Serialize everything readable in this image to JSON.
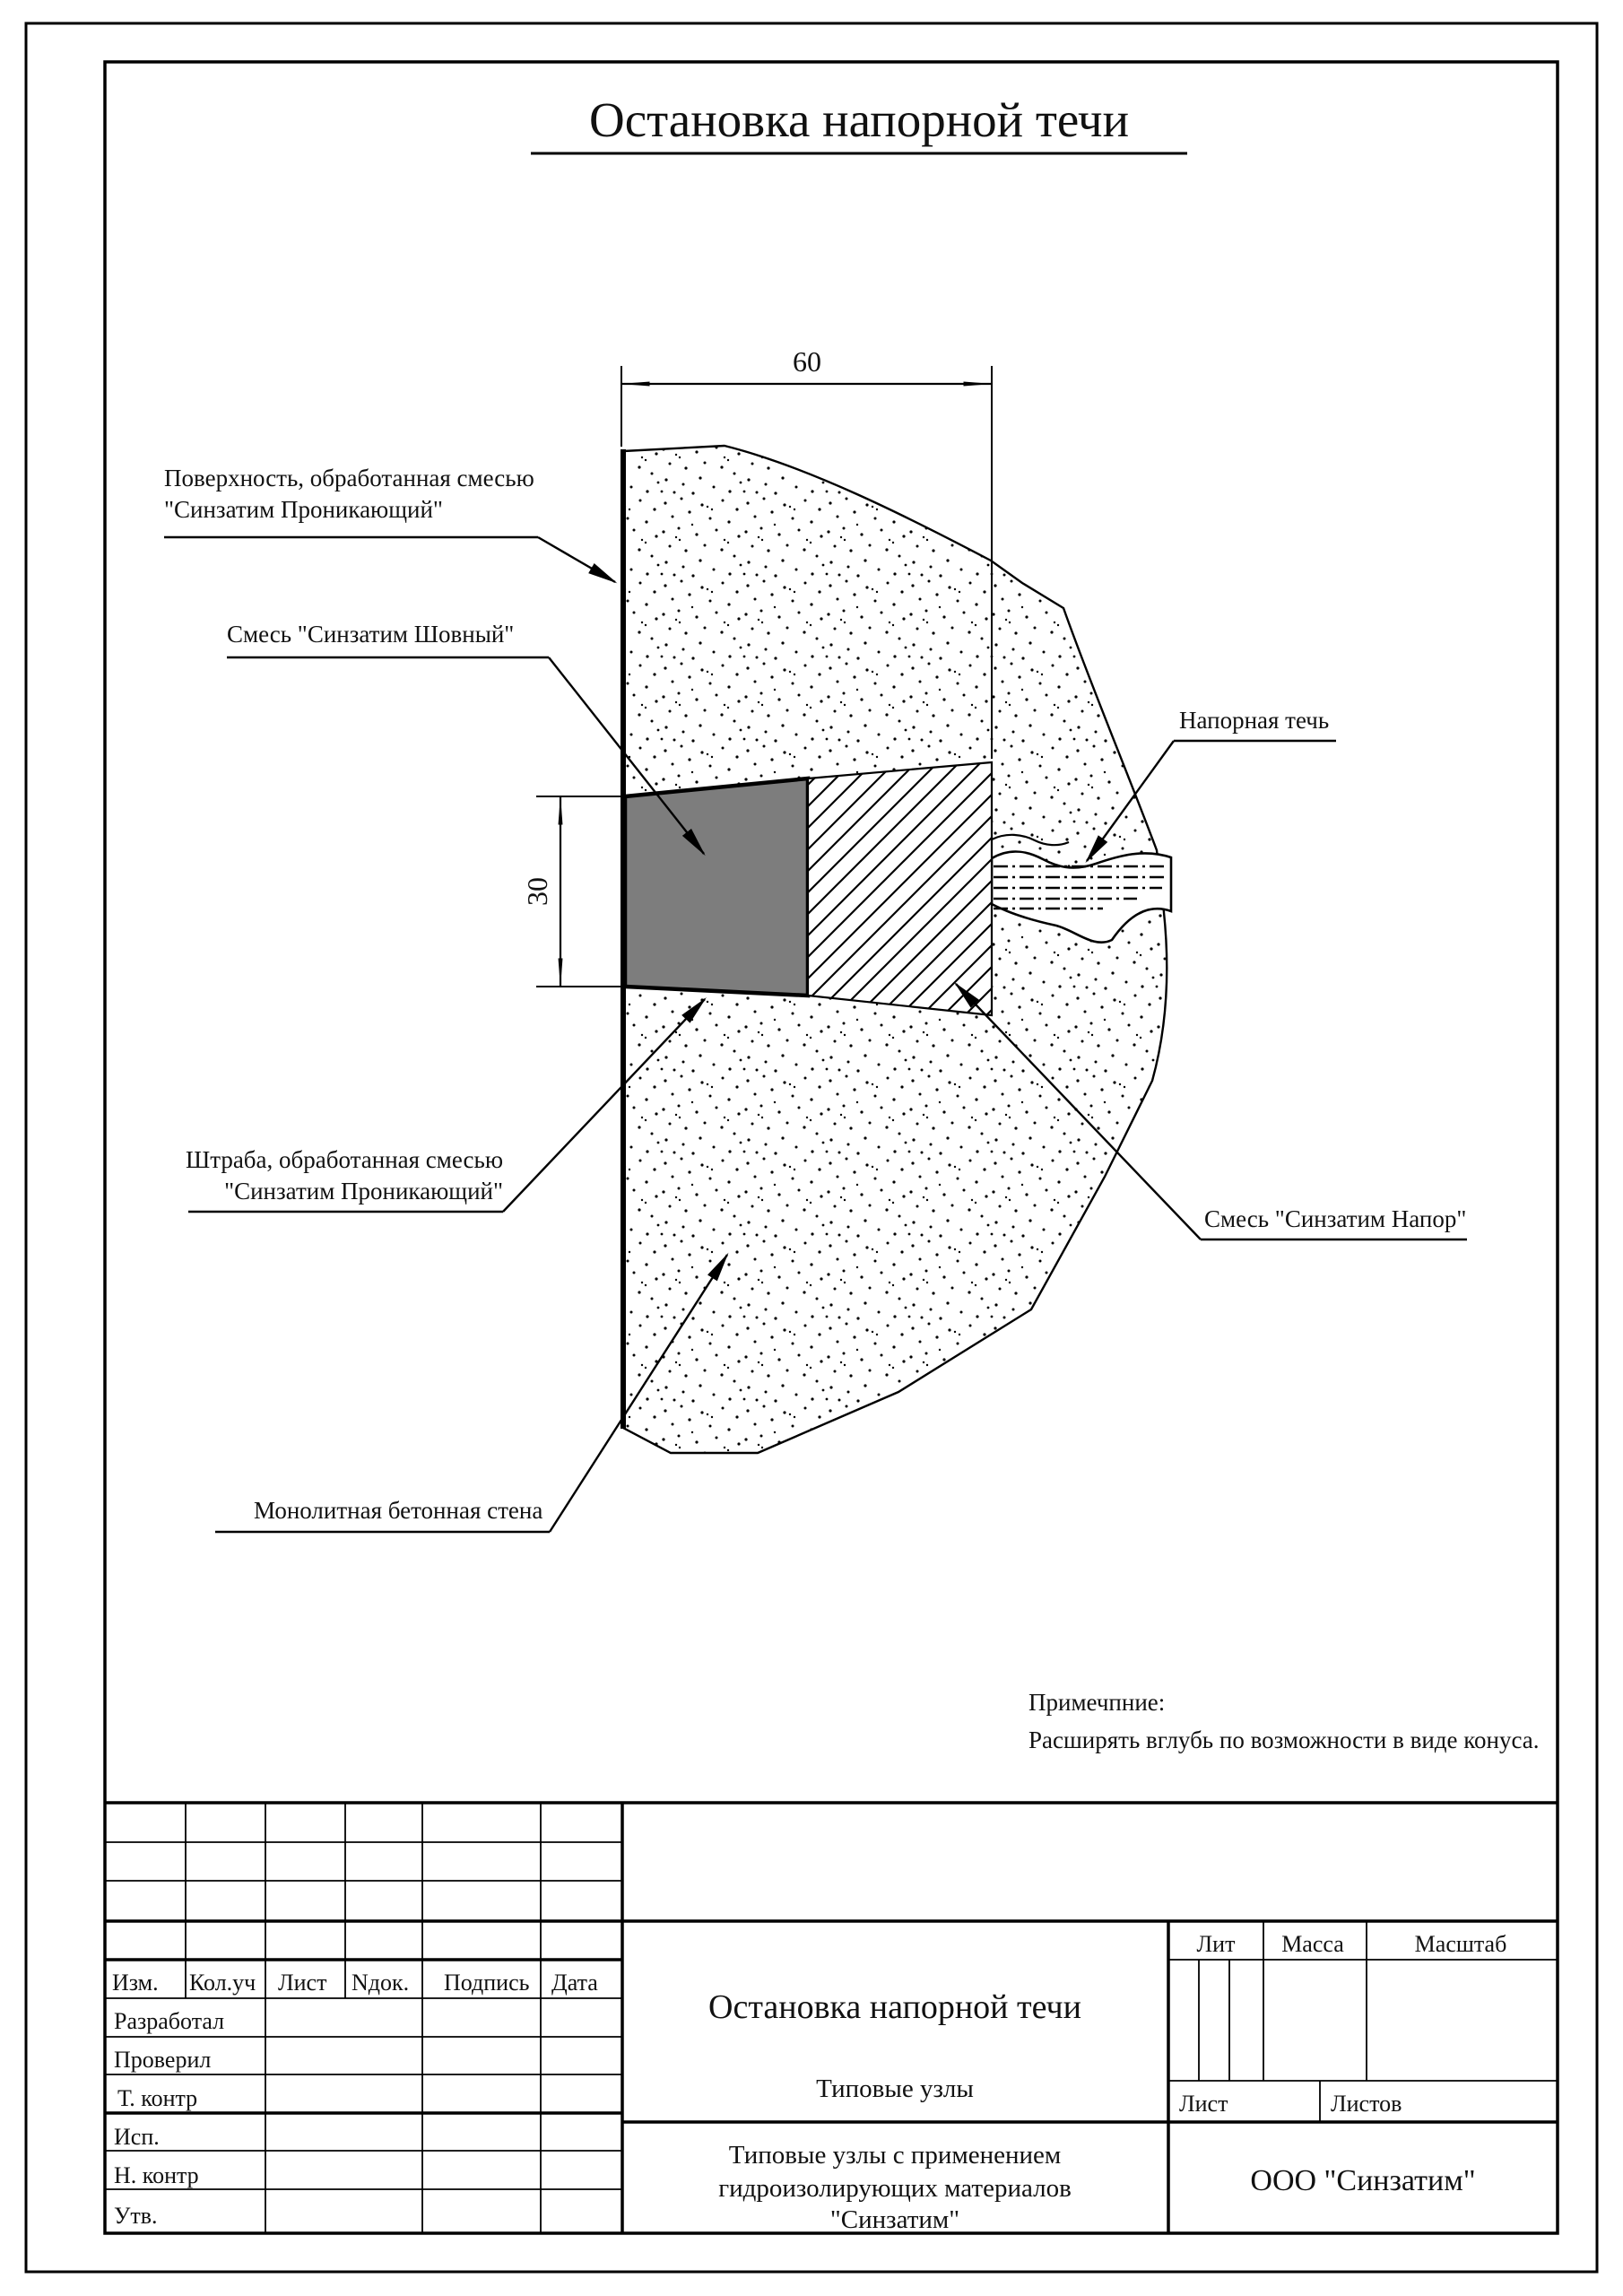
{
  "page_title": "Остановка напорной течи",
  "diagram": {
    "dim_width": "60",
    "dim_height": "30",
    "labels": {
      "surface_line1": "Поверхность, обработанная смесью",
      "surface_line2": "\"Синзатим Проникающий\"",
      "seam_mix": "Смесь \"Синзатим Шовный\"",
      "pressure_leak": "Напорная течь",
      "groove_line1": "Штраба, обработанная смесью",
      "groove_line2": "\"Синзатим Проникающий\"",
      "pressure_mix": "Смесь \"Синзатим Напор\"",
      "wall": "Монолитная бетонная стена"
    },
    "note_line1": "Примечпние:",
    "note_line2": "Расширять вглубь по возможности в виде конуса."
  },
  "title_block": {
    "header_cols": [
      "Изм.",
      "Кол.уч",
      "Лист",
      "Nдок.",
      "Подпись",
      "Дата"
    ],
    "rows": [
      "Разработал",
      "Проверил",
      "Т. контр",
      "Исп.",
      "Н. контр",
      "Утв."
    ],
    "doc_title": "Остановка напорной течи",
    "doc_subtitle": "Типовые узлы",
    "project_line1": "Типовые узлы с применением",
    "project_line2": "гидроизолирующих материалов",
    "project_line3": "\"Синзатим\"",
    "lit": "Лит",
    "massa": "Масса",
    "masshtab": "Масштаб",
    "list": "Лист",
    "listov": "Листов",
    "company": "ООО \"Синзатим\""
  },
  "colors": {
    "ink": "#000000",
    "groove_fill": "#7d7d7d",
    "paper": "#ffffff"
  }
}
